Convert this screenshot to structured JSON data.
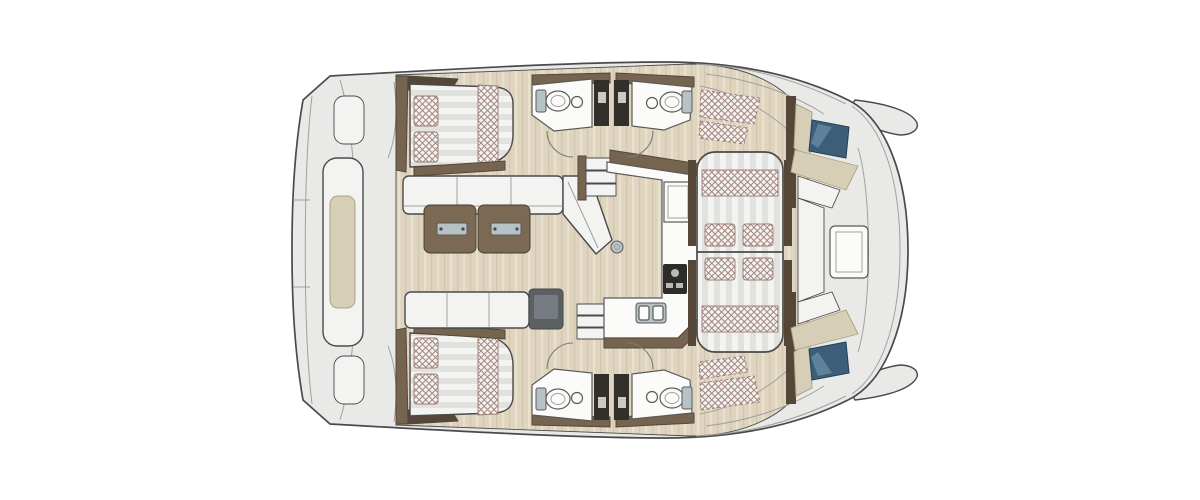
{
  "figure": {
    "kind": "catamaran-deck-floor-plan",
    "view": "top-down",
    "orientation": "bow-right-stern-left",
    "visible_text": ""
  },
  "colors": {
    "background": "#ffffff",
    "outline": "#4a4a4a",
    "deck": "#e9e9e7",
    "deck_line": "#a0a09e",
    "door_arc": "#7a7a78",
    "wood": "#ded4bf",
    "wood_grain_dark": "#d2c7ab",
    "wood_grain_light": "#e9e1cd",
    "brown": "#75644f",
    "brown_dark": "#554738",
    "table_wood": "#7b6954",
    "table_edge": "#463b2e",
    "cushion": "#f3f3f1",
    "cushion_stripe": "#e1e1de",
    "beige_pad": "#d7ceb8",
    "beige_edge": "#ada380",
    "check_line": "#9b7a72",
    "dark_unit": "#33302b",
    "unit_slit": "#c9c9c7",
    "module": "#5b6065",
    "module_inner": "#767c82",
    "hatch_blue": "#3d5e79",
    "hatch_blue_light": "#7293ab",
    "hatch_blue_dark": "#22405a",
    "fixture": "#fbfbfa",
    "fixture_edge": "#5a5a58",
    "metal": "#b7c2c7",
    "stove": "#2e2c29",
    "stove_light": "#b9b9b7"
  },
  "components": {
    "hull": "catamaran hull with twin bow tips",
    "stern_platform": "aft platform with central bench seat",
    "aft_cabins": "two double-bed cabins with pillows and bolsters",
    "saloon": "L-shaped sofa, facing sofa, split wooden table, cooler module",
    "galley": "L-shaped counter with appliance, stove and double sink",
    "heads": "four bathroom compartments with toilet, sink and shower columns",
    "stairs": "two companionway step sets",
    "forward_lounge": "double chaise sunbed with four cushions",
    "optional_sunpads": "dashed cross-hatched pad areas",
    "deck_hatches": "two blue forward deck windows",
    "bow_cockpit": "U seating with backrests and table"
  }
}
